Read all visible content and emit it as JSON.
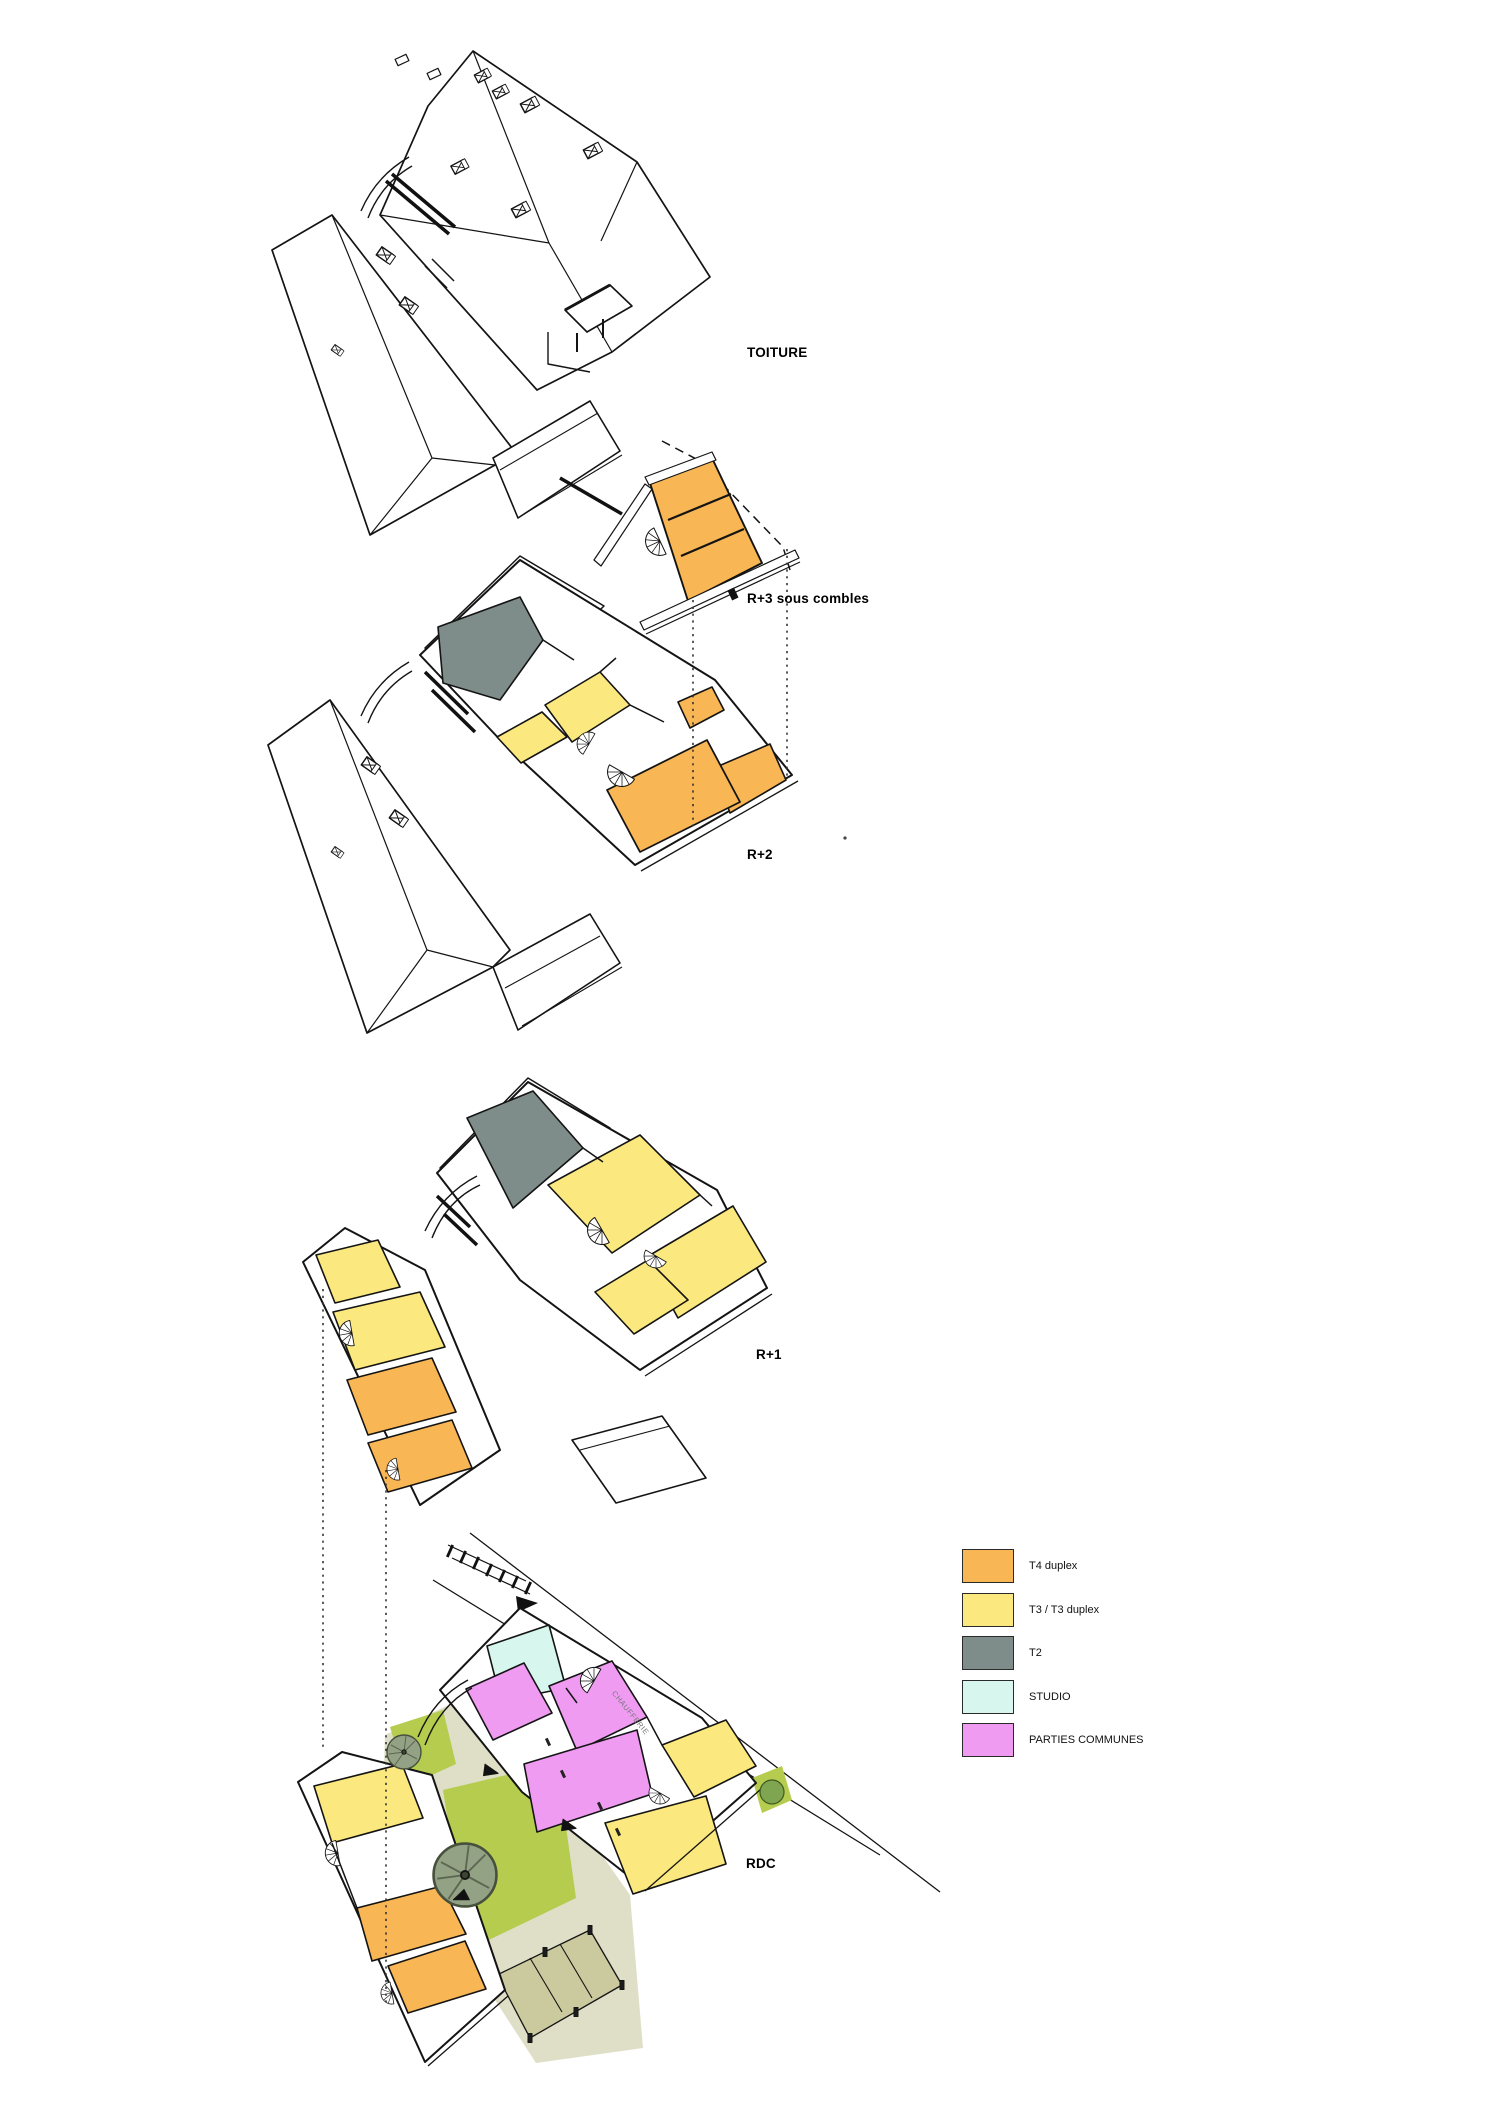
{
  "labels": {
    "toiture": "TOITURE",
    "r3": "R+3 sous combles",
    "r2": "R+2",
    "r1": "R+1",
    "rdc": "RDC",
    "chaufferie": "CHAUFFERIE"
  },
  "legend": {
    "items": [
      {
        "label": "T4 duplex",
        "color": "#F9B655"
      },
      {
        "label": "T3 / T3 duplex",
        "color": "#FBE87E"
      },
      {
        "label": "T2",
        "color": "#7E8D89"
      },
      {
        "label": "STUDIO",
        "color": "#D7F6EE"
      },
      {
        "label": "PARTIES COMMUNES",
        "color": "#F09BF2"
      }
    ]
  },
  "colors": {
    "outline": "#141414",
    "t4_duplex": "#F9B655",
    "t3_duplex": "#FBE87E",
    "t2": "#7E8D89",
    "studio": "#D7F6EE",
    "parties_communes": "#F09BF2",
    "lawn_green": "#B5CC4E",
    "path_beige": "#DFDEC6",
    "terrace_khaki": "#CBCA9F",
    "tree_green": "#93A184"
  }
}
